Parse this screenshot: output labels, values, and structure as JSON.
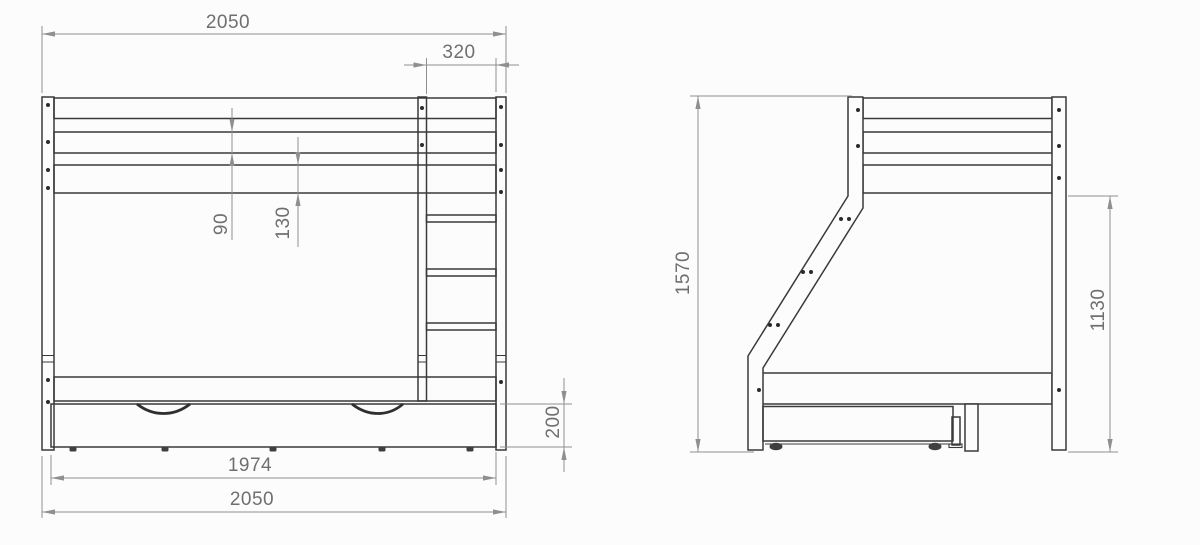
{
  "drawing_type": "bunk-bed technical drawing, front and side elevation",
  "colors": {
    "line": "#3a3a3a",
    "dimension": "#8f8f8f",
    "text": "#6f6f6f",
    "background": "#fcfcfc"
  },
  "front_view": {
    "name": "front elevation",
    "dimensions": {
      "overall_width_top": "2050",
      "ladder_width": "320",
      "guard_rail_plank_height": "90",
      "bed_rail_plank_height": "130",
      "drawer_height": "200",
      "drawer_width": "1974",
      "overall_width_bottom": "2050"
    }
  },
  "side_view": {
    "name": "side elevation",
    "dimensions": {
      "overall_height": "1570",
      "underside_clearance_height": "1130"
    }
  }
}
